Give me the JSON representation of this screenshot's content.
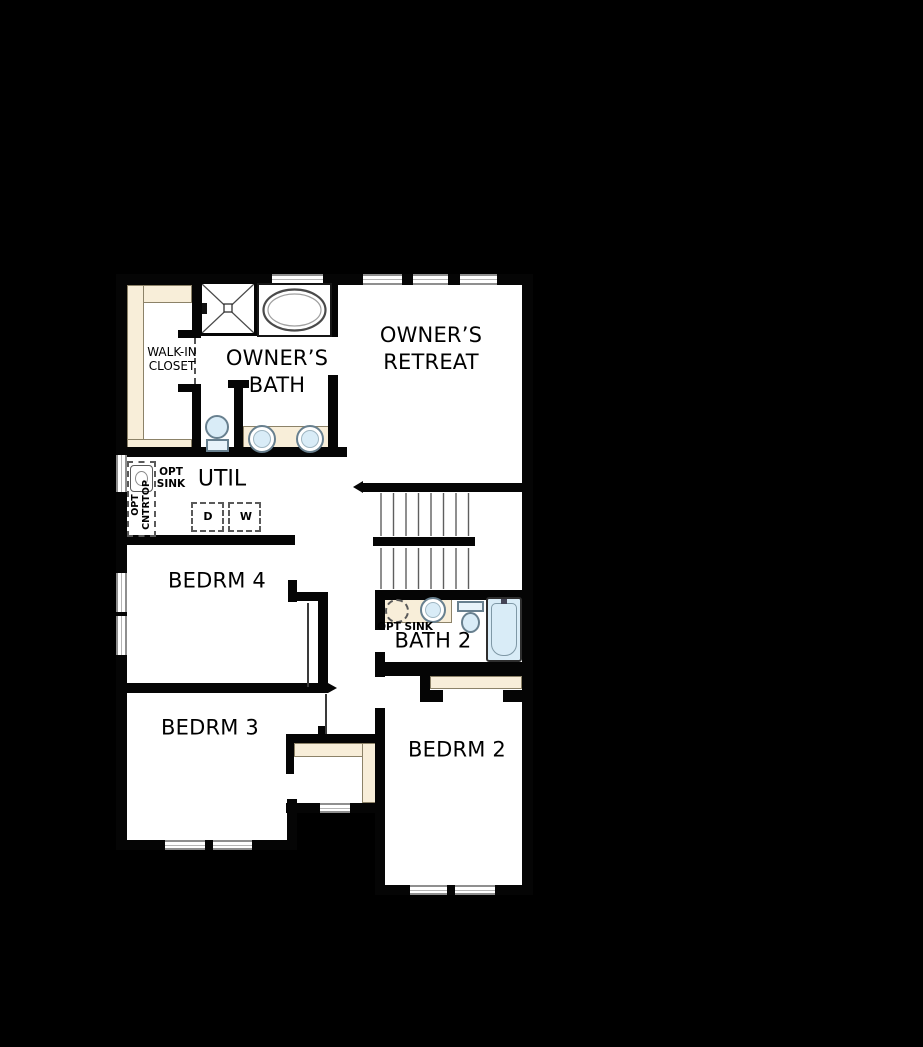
{
  "plan_title": "second-floor plan",
  "colors": {
    "background": "#000000",
    "floor": "#ffffff",
    "walls": "#050505",
    "shelving_counter": "#f8eed9",
    "fixture_fill": "#d9ecf7",
    "window_line": "#8f8f8f"
  },
  "rooms": {
    "walk_in_closet": {
      "line1": "WALK-IN",
      "line2": "CLOSET"
    },
    "owners_bath": {
      "line1": "OWNER’S",
      "line2": "BATH"
    },
    "owners_retreat": {
      "line1": "OWNER’S",
      "line2": "RETREAT"
    },
    "util": {
      "label": "UTIL"
    },
    "bedrm4": {
      "label": "BEDRM 4"
    },
    "bedrm3": {
      "label": "BEDRM 3"
    },
    "bedrm2": {
      "label": "BEDRM 2"
    },
    "bath2": {
      "label": "BATH 2"
    }
  },
  "options": {
    "util_opt_sink": {
      "line1": "OPT",
      "line2": "SINK"
    },
    "util_opt_countertop": {
      "line1": "OPT",
      "line2": "CNTRTOP"
    },
    "bath2_opt_sink": {
      "label": "OPT SINK"
    }
  },
  "appliances": {
    "dryer": "D",
    "washer": "W"
  }
}
